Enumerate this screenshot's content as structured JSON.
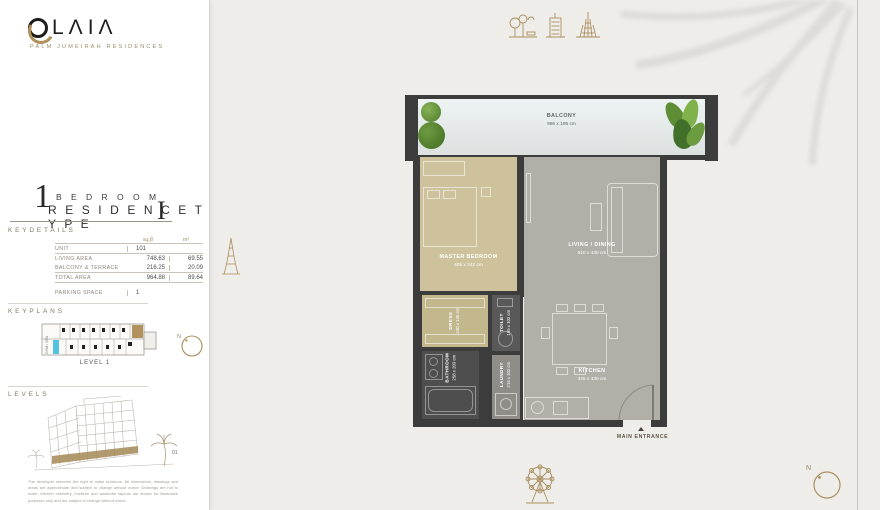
{
  "brand": {
    "o": "O",
    "rest": "LΛIΛ",
    "tagline": "PALM JUMEIRAH RESIDENCES"
  },
  "title": {
    "number": "1",
    "bedroom": "B E D R O O M",
    "residence": "R E S I D E N C E   T Y P E",
    "numeral": "I"
  },
  "keydetails": {
    "heading": "KEYDETAILS",
    "columns": {
      "sqft": "sq.ft",
      "sqm": "m²"
    },
    "unit": {
      "label": "UNIT",
      "value": "101"
    },
    "rows": [
      {
        "label": "LIVING AREA",
        "sqft": "748.63",
        "sqm": "69.55"
      },
      {
        "label": "BALCONY & TERRACE",
        "sqft": "216.25",
        "sqm": "20.09"
      },
      {
        "label": "TOTAL AREA",
        "sqft": "964.88",
        "sqm": "89.64"
      }
    ],
    "parking": {
      "label": "PARKING SPACE",
      "value": "1"
    }
  },
  "keyplans": {
    "heading": "KEYPLANS",
    "level": "LEVEL 1",
    "gym": "GYM / SPA",
    "north": "N"
  },
  "levels": {
    "heading": "LEVELS",
    "floor_tag": "01"
  },
  "floorplan": {
    "balcony": {
      "name": "BALCONY",
      "dims": "995 x 195 cm"
    },
    "master": {
      "name": "MASTER BEDROOM",
      "dims": "405 x 342 cm"
    },
    "living": {
      "name": "LIVING / DINING",
      "dims": "510 x 430 cm"
    },
    "kitchen": {
      "name": "KITCHEN",
      "dims": "325 x 430 cm"
    },
    "dress": {
      "name": "DRESS",
      "dims": "240 x 145 cm"
    },
    "toilet": {
      "name": "TOILET",
      "dims": "195 x 102 cm"
    },
    "bathroom": {
      "name": "BATHROOM",
      "dims": "258 x 203 cm"
    },
    "laundry": {
      "name": "LAUNDRY",
      "dims": "216 x 102 cm"
    },
    "entrance": "MAIN ENTRANCE",
    "north": "N"
  },
  "disclaimer": "The developer reserves the right to make revisions. All dimensions, drawings and areas are approximate and subject to change without notice. Drawings are not to scale. Kitchen cabinetry, furniture and wardrobe layouts are shown for illustrative purposes only and are subject to change without notice.",
  "colors": {
    "accent_gold": "#a98f5e",
    "wall": "#3c3c3c",
    "master_tan": "#cdc29b",
    "living_grey": "#b2afa9",
    "pool_blue": "#54c2e0"
  }
}
